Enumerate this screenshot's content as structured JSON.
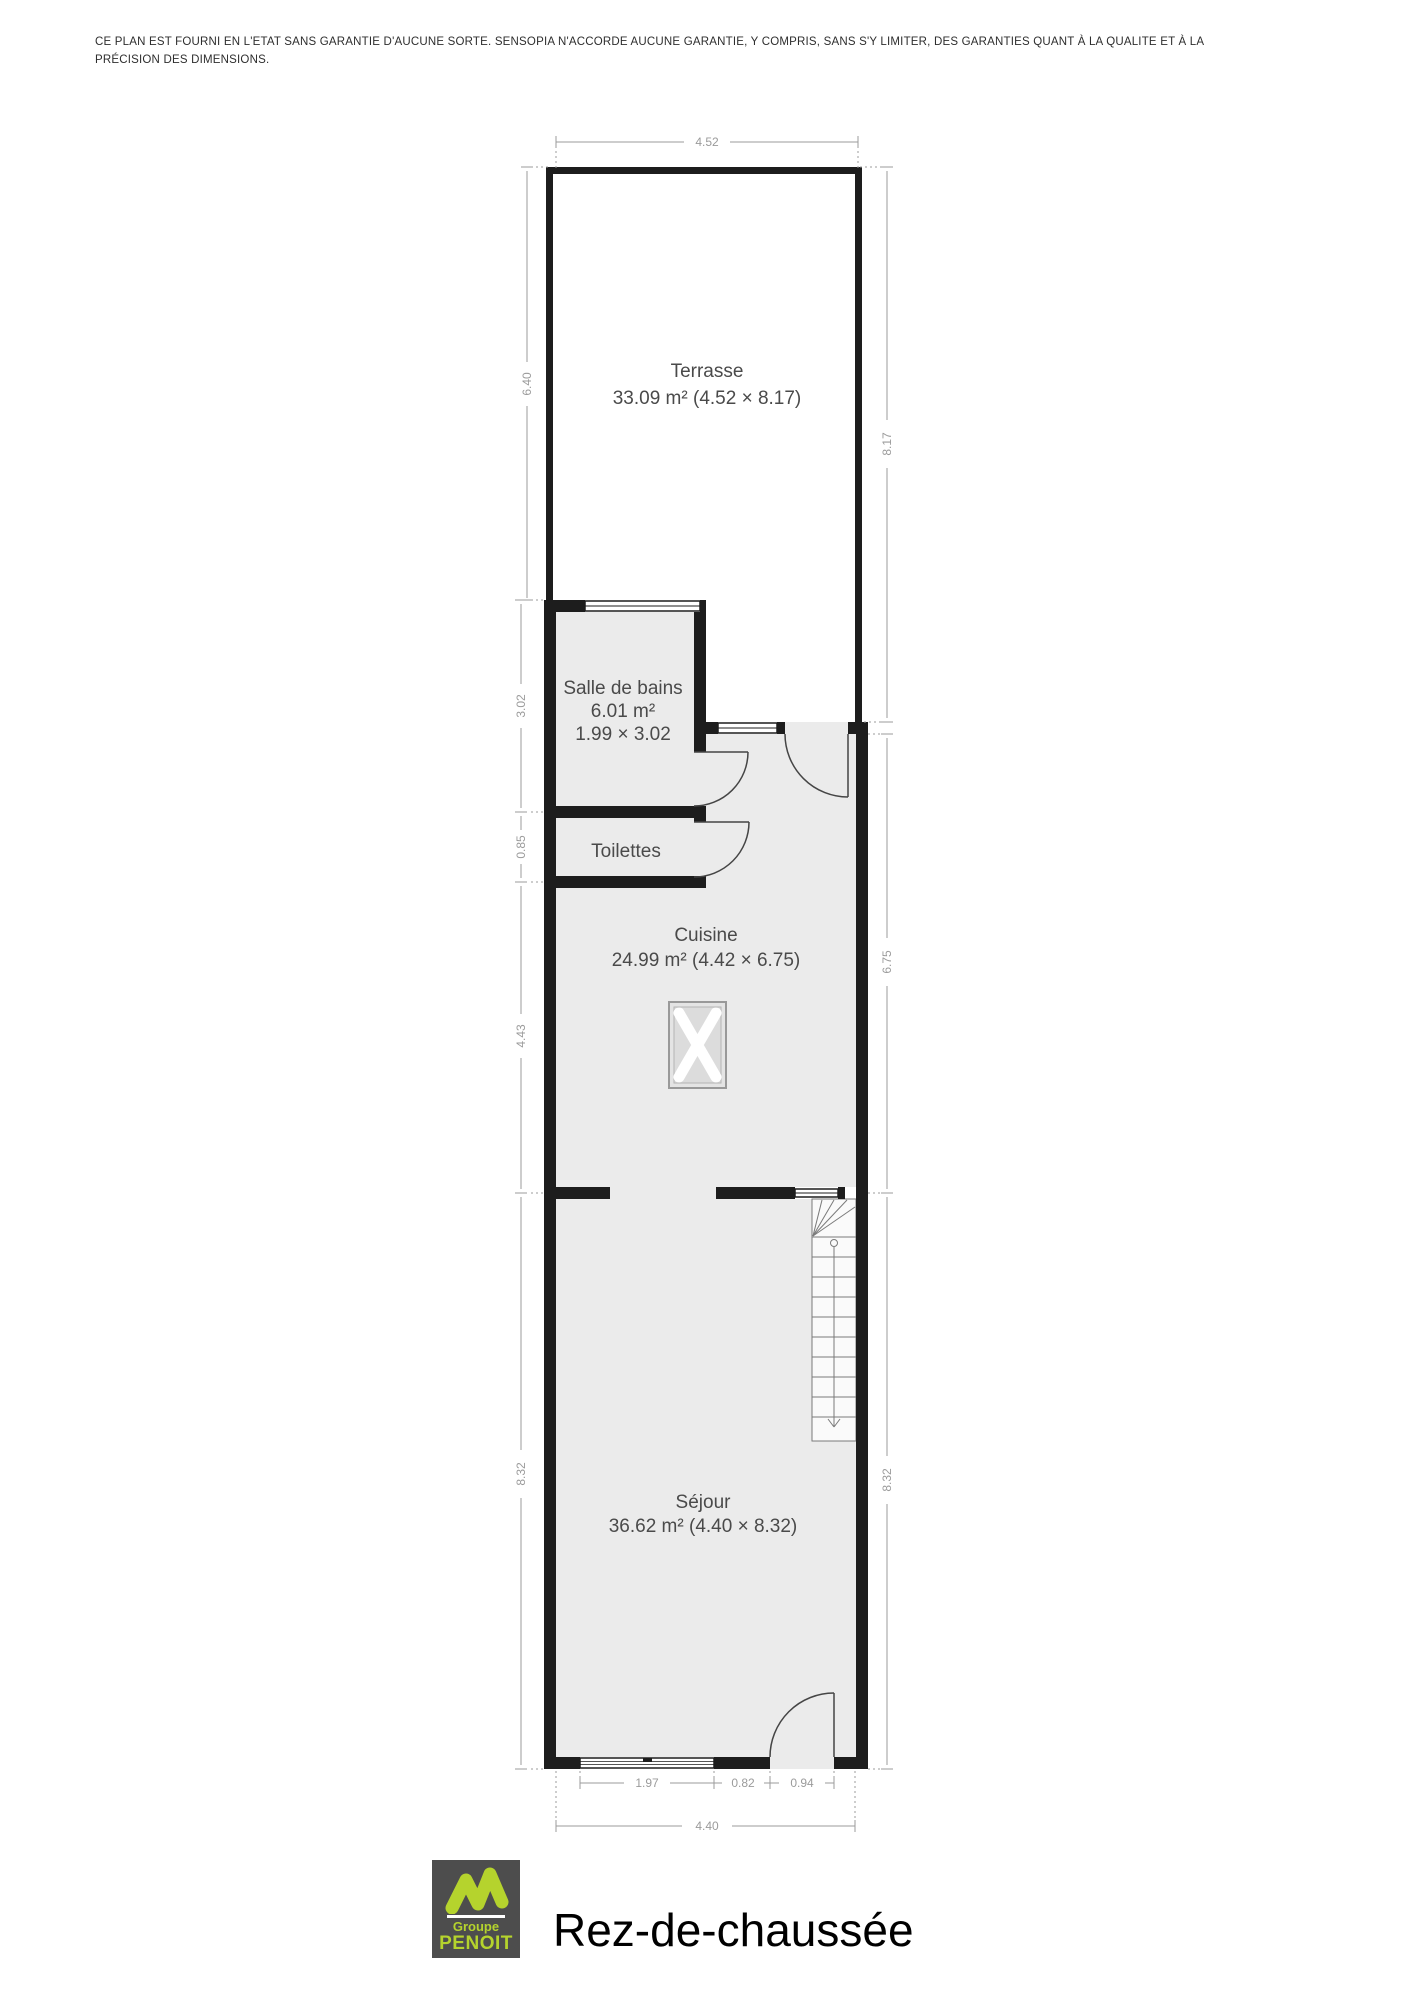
{
  "disclaimer": {
    "line1": "CE PLAN EST FOURNI EN L'ETAT SANS GARANTIE D'AUCUNE SORTE. SENSOPIA N'ACCORDE AUCUNE GARANTIE, Y COMPRIS, SANS S'Y LIMITER, DES GARANTIES QUANT À LA QUALITE ET À LA",
    "line2": "PRÉCISION DES DIMENSIONS."
  },
  "plan": {
    "rooms": {
      "terrasse": {
        "name": "Terrasse",
        "area": "33.09 m² (4.52 × 8.17)"
      },
      "salle_de_bains": {
        "name": "Salle de bains",
        "area": "6.01 m²",
        "dims": "1.99 × 3.02"
      },
      "toilettes": {
        "name": "Toilettes"
      },
      "cuisine": {
        "name": "Cuisine",
        "area": "24.99 m² (4.42 × 6.75)"
      },
      "sejour": {
        "name": "Séjour",
        "area": "36.62 m² (4.40 × 8.32)"
      }
    },
    "dimensions": {
      "top_width": "4.52",
      "left_terrasse": "6.40",
      "left_salle_de_bains": "3.02",
      "left_toilettes": "0.85",
      "left_cuisine": "4.43",
      "left_sejour": "8.32",
      "right_terrasse": "8.17",
      "right_cuisine": "6.75",
      "right_sejour": "8.32",
      "bottom_window": "1.97",
      "bottom_pier": "0.82",
      "bottom_door": "0.94",
      "bottom_total": "4.40"
    }
  },
  "footer": {
    "logo": {
      "line1": "Groupe",
      "line2": "PENOIT"
    },
    "title": "Rez-de-chaussée"
  },
  "colors": {
    "wall": "#1d1d1d",
    "room_fill": "#ebebeb",
    "dimension": "#9b9b9b",
    "label": "#4a4a4a",
    "logo_green": "#b5d32d",
    "logo_bg": "#4d4d4d"
  }
}
